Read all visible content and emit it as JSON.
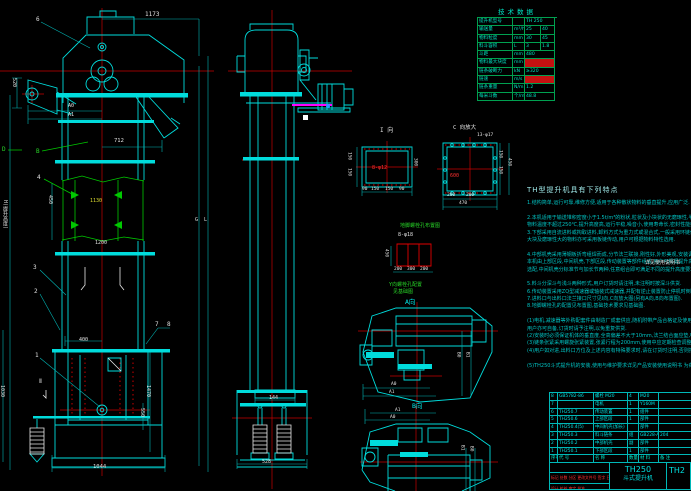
{
  "canvas": {
    "width": 691,
    "height": 491,
    "background": "#000000"
  },
  "colors": {
    "line": "#00dcdc",
    "centerline": "#cc0000",
    "green": "#00c800",
    "white": "#e8e8e8",
    "yellow": "#d8d830",
    "magenta": "#ff00ff",
    "table_line": "#00a050",
    "highlight_red": "#c41111"
  },
  "tech_table": {
    "title": "技术数据",
    "rows": [
      {
        "name": "提升机型号",
        "unit": "",
        "v1": "TH 250",
        "v2": "",
        "red": false
      },
      {
        "name": "输送量",
        "unit": "m³/h",
        "v1": "25",
        "v2": "40",
        "red": false
      },
      {
        "name": "物料粒度",
        "unit": "mm",
        "v1": "30",
        "v2": "45",
        "red": false
      },
      {
        "name": "料斗容积",
        "unit": "L",
        "v1": "3",
        "v2": "1.8",
        "red": false
      },
      {
        "name": "斗距",
        "unit": "mm",
        "v1": "480",
        "v2": "",
        "red": false
      },
      {
        "name": "物料最大块度",
        "unit": "mm",
        "v1": "",
        "v2": "",
        "red": true
      },
      {
        "name": "链条破断力",
        "unit": "kN",
        "v1": "≥320",
        "v2": "",
        "red": false
      },
      {
        "name": "链速",
        "unit": "m/s",
        "v1": "",
        "v2": "",
        "red": true
      },
      {
        "name": "链条重量",
        "unit": "N/m",
        "v1": "1.2",
        "v2": "",
        "red": false
      },
      {
        "name": "每米斗数",
        "unit": "个/m",
        "v1": "48.8",
        "v2": "",
        "red": false
      }
    ]
  },
  "notes": {
    "title": "TH型提升机具有下列特点",
    "lines": [
      "1.结构简单,运行可靠,维修方便,适用于各种散状物料的垂直提升,应用广泛.",
      "",
      "2.本机适用于输送堆积密度小于1.5t/m³的粉状,粒状及小块状的无磨琢性,半磨琢性物料,",
      "  物料温度不超过250℃,提升高度高,运行平稳,噪音小,使用寿命长,密封性能好.",
      "3.下部采用自流进料或掏取进料,卸料方式为重力式或混合式,一般采用环链传动,对于",
      "  大块及磨琢性大的物料亦可采用板链传动,用户可根据物料特性选用.",
      "",
      "4.中部机壳采用薄钢板折弯组焊而成,分节法兰联接,刚性好,外形美观,安装调整方便,",
      "  本机由上部区段,中间机壳,下部区段,传动装置等部件组成,用户可根据提升高度自由",
      "  选配,中间机壳分标准节与加长节两种,任意组合即可满足不同的提升高度要求.",
      "",
      "5.料斗分深斗与浅斗两种形式,用户订货时请注明,未注明时按深斗供货.",
      "6.传动装置采用ZQ型减速器或轴装式减速器,并配有逆止装置防止停机时倒转.",
      "7.进料口与出料口法兰接口尺寸见I向,C向放大图(另有A向,B向布置图).",
      "8.地脚螺栓孔的配置见布置图,基础技术要求见基础图.",
      "",
      "(1)电机,减速器等外购配套件由制造厂成套供应,随机附带产品合格证及使用说明书,",
      "  用户亦可自备,订货时请予注明,以免重复供货.",
      "(2)安装时必须保证机体的垂直度,全高偏差不大于10mm,法兰结合面应垫入密封材料.",
      "(3)链条张紧采用螺旋张紧装置,张紧行程为200mm,使用中应定期检查调整.",
      "(4)用户如对进,出料口方位及上述内容有特殊要求时,请在订货时注明,否则按本图制造.",
      "",
      "(5)TH250斗式提升机的安装,使用与维护要求详见产品安装使用说明书 为荷."
    ]
  },
  "bom": {
    "headers": [
      "序号",
      "代 号",
      "名 称",
      "数量",
      "材 料",
      "备 注"
    ],
    "rows": [
      [
        "8",
        "GB5782-86",
        "螺栓 M20",
        "4",
        "M20",
        ""
      ],
      [
        "7",
        "",
        "电机",
        "1",
        "Y160M",
        ""
      ],
      [
        "6",
        "TH250.7",
        "传动装置",
        "1",
        "组件",
        ""
      ],
      [
        "5",
        "TH250.6",
        "上部区段",
        "1",
        "部件",
        ""
      ],
      [
        "4",
        "TH250.4(5)",
        "中间机壳(加长)",
        "",
        "部件",
        ""
      ],
      [
        "3",
        "TH250.3",
        "料斗链条",
        "组",
        "GB228-A",
        "204"
      ],
      [
        "2",
        "TH250.2",
        "中部机壳",
        "副",
        "部件",
        ""
      ],
      [
        "1",
        "TH250.1",
        "下部区段",
        "1",
        "部件",
        ""
      ]
    ]
  },
  "title_block": {
    "model": "TH250",
    "product": "斗式提升机",
    "doc_no": "TH2",
    "sign_row": "标记 处数 分区 更改文件号 签字 日期",
    "approve_row": "设计  校核  审定  批准"
  },
  "annotations": [
    {
      "t": "1173",
      "x": 145,
      "y": 12,
      "c": "w",
      "s": 6
    },
    {
      "t": "6",
      "x": 36,
      "y": 17,
      "c": "w",
      "s": 6
    },
    {
      "t": "520",
      "x": 11,
      "y": 78,
      "c": "w",
      "s": 5,
      "rot": 1
    },
    {
      "t": "A0",
      "x": 68,
      "y": 104,
      "c": "w",
      "s": 5
    },
    {
      "t": "A1",
      "x": 68,
      "y": 113,
      "c": "w",
      "s": 5
    },
    {
      "t": "712",
      "x": 114,
      "y": 139,
      "c": "w",
      "s": 5.5
    },
    {
      "t": "D",
      "x": 2,
      "y": 147,
      "c": "g",
      "s": 6
    },
    {
      "t": "B",
      "x": 36,
      "y": 149,
      "c": "g",
      "s": 6
    },
    {
      "t": "4",
      "x": 37,
      "y": 175,
      "c": "w",
      "s": 6
    },
    {
      "t": "450",
      "x": 47,
      "y": 195,
      "c": "w",
      "s": 5,
      "rot": 1
    },
    {
      "t": "1130",
      "x": 90,
      "y": 199,
      "c": "y",
      "s": 5
    },
    {
      "t": "H(提升高度)",
      "x": 2,
      "y": 200,
      "c": "w",
      "s": 5,
      "rot": 1
    },
    {
      "t": "G",
      "x": 195,
      "y": 218,
      "c": "w",
      "s": 5
    },
    {
      "t": "L",
      "x": 204,
      "y": 218,
      "c": "w",
      "s": 5
    },
    {
      "t": "1200",
      "x": 95,
      "y": 241,
      "c": "w",
      "s": 5
    },
    {
      "t": "3",
      "x": 33,
      "y": 265,
      "c": "w",
      "s": 6
    },
    {
      "t": "2",
      "x": 34,
      "y": 289,
      "c": "w",
      "s": 6
    },
    {
      "t": "7",
      "x": 155,
      "y": 322,
      "c": "w",
      "s": 6
    },
    {
      "t": "8",
      "x": 167,
      "y": 322,
      "c": "w",
      "s": 6
    },
    {
      "t": "400",
      "x": 79,
      "y": 338,
      "c": "w",
      "s": 5
    },
    {
      "t": "1",
      "x": 35,
      "y": 353,
      "c": "w",
      "s": 6
    },
    {
      "t": "Ⅱ",
      "x": 39,
      "y": 379,
      "c": "w",
      "s": 6
    },
    {
      "t": "1030",
      "x": -1,
      "y": 385,
      "c": "w",
      "s": 5,
      "rot": 1
    },
    {
      "t": "1470",
      "x": 145,
      "y": 385,
      "c": "w",
      "s": 5,
      "rot": 1
    },
    {
      "t": "550",
      "x": 139,
      "y": 408,
      "c": "w",
      "s": 5,
      "rot": 1
    },
    {
      "t": "1044",
      "x": 93,
      "y": 465,
      "c": "w",
      "s": 5.5
    },
    {
      "t": "144",
      "x": 269,
      "y": 396,
      "c": "w",
      "s": 5
    },
    {
      "t": "528",
      "x": 262,
      "y": 460,
      "c": "w",
      "s": 5
    },
    {
      "t": "I 向",
      "x": 380,
      "y": 128,
      "c": "w",
      "s": 6
    },
    {
      "t": "8-φ12",
      "x": 372,
      "y": 166,
      "c": "r",
      "s": 5
    },
    {
      "t": "150",
      "x": 346,
      "y": 152,
      "c": "w",
      "s": 4.5,
      "rot": 1
    },
    {
      "t": "150",
      "x": 346,
      "y": 168,
      "c": "w",
      "s": 4.5,
      "rot": 1
    },
    {
      "t": "300",
      "x": 412,
      "y": 158,
      "c": "w",
      "s": 4.5,
      "rot": 1
    },
    {
      "t": "90",
      "x": 362,
      "y": 188,
      "c": "w",
      "s": 4.5
    },
    {
      "t": "150",
      "x": 371,
      "y": 188,
      "c": "w",
      "s": 4.5
    },
    {
      "t": "150",
      "x": 385,
      "y": 188,
      "c": "w",
      "s": 4.5
    },
    {
      "t": "90",
      "x": 399,
      "y": 188,
      "c": "w",
      "s": 4.5
    },
    {
      "t": "C 向放大",
      "x": 453,
      "y": 126,
      "c": "w",
      "s": 5.5
    },
    {
      "t": "13-φ17",
      "x": 477,
      "y": 134,
      "c": "w",
      "s": 4.5
    },
    {
      "t": "600",
      "x": 450,
      "y": 174,
      "c": "r",
      "s": 5
    },
    {
      "t": "150",
      "x": 497,
      "y": 150,
      "c": "w",
      "s": 4.5,
      "rot": 1
    },
    {
      "t": "150",
      "x": 497,
      "y": 166,
      "c": "w",
      "s": 4.5,
      "rot": 1
    },
    {
      "t": "450",
      "x": 506,
      "y": 158,
      "c": "w",
      "s": 4.5,
      "rot": 1
    },
    {
      "t": "200",
      "x": 447,
      "y": 194,
      "c": "w",
      "s": 4.5
    },
    {
      "t": "200",
      "x": 466,
      "y": 194,
      "c": "w",
      "s": 4.5
    },
    {
      "t": "470",
      "x": 459,
      "y": 202,
      "c": "w",
      "s": 4.5
    },
    {
      "t": "地脚螺栓孔布置图",
      "x": 400,
      "y": 224,
      "c": "g",
      "s": 5
    },
    {
      "t": "8-φ18",
      "x": 398,
      "y": 233,
      "c": "w",
      "s": 5
    },
    {
      "t": "450",
      "x": 383,
      "y": 249,
      "c": "w",
      "s": 4.5,
      "rot": 1
    },
    {
      "t": "200",
      "x": 394,
      "y": 268,
      "c": "w",
      "s": 4.5
    },
    {
      "t": "300",
      "x": 407,
      "y": 268,
      "c": "w",
      "s": 4.5
    },
    {
      "t": "200",
      "x": 420,
      "y": 268,
      "c": "w",
      "s": 4.5
    },
    {
      "t": "Y向螺栓孔配置",
      "x": 389,
      "y": 283,
      "c": "g",
      "s": 5
    },
    {
      "t": "见基础图",
      "x": 393,
      "y": 290,
      "c": "g",
      "s": 5
    },
    {
      "t": "A向",
      "x": 405,
      "y": 299,
      "c": "c",
      "s": 6.5
    },
    {
      "t": "B0",
      "x": 455,
      "y": 352,
      "c": "w",
      "s": 4.5,
      "rot": 1
    },
    {
      "t": "B1",
      "x": 464,
      "y": 352,
      "c": "w",
      "s": 4.5,
      "rot": 1
    },
    {
      "t": "A0",
      "x": 391,
      "y": 383,
      "c": "w",
      "s": 4.5
    },
    {
      "t": "A1",
      "x": 389,
      "y": 391,
      "c": "w",
      "s": 4.5
    },
    {
      "t": "B向",
      "x": 412,
      "y": 403,
      "c": "c",
      "s": 6.5
    },
    {
      "t": "A1",
      "x": 395,
      "y": 409,
      "c": "w",
      "s": 4.5
    },
    {
      "t": "A0",
      "x": 390,
      "y": 416,
      "c": "w",
      "s": 4.5
    },
    {
      "t": "B1",
      "x": 459,
      "y": 445,
      "c": "w",
      "s": 4.5,
      "rot": 1
    },
    {
      "t": "B0",
      "x": 468,
      "y": 446,
      "c": "w",
      "s": 4.5,
      "rot": 1
    },
    {
      "t": "详见使用说明书",
      "x": 645,
      "y": 261,
      "c": "w",
      "s": 5
    }
  ]
}
